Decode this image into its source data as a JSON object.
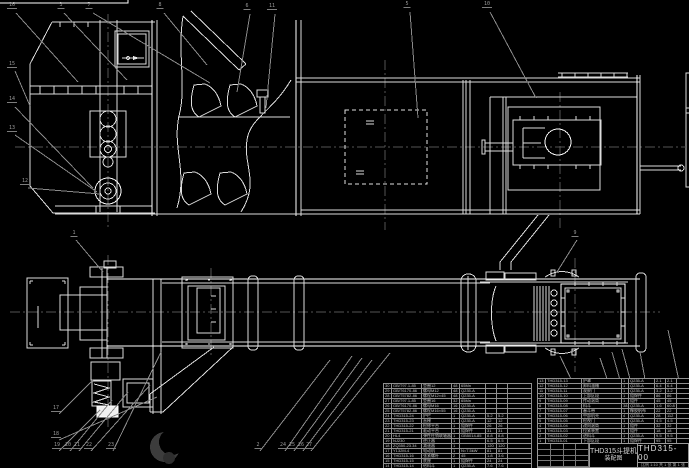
{
  "drawing": {
    "title_line1": "THD315斗提机",
    "title_line2": "装配图",
    "drawing_number": "THD315-00",
    "title_block_note": "比例 1:10  共 1 张  第 1 张"
  },
  "colors": {
    "background": "#000000",
    "drawing_line": "#dcdcdc",
    "leader_line": "#8a8a8a",
    "table_grid": "#8f8f8f",
    "watermark": "#3c3c3c"
  },
  "icons": {
    "watermark": "crescent-logo",
    "hatch_symbol": "flow-arrow-icon"
  },
  "bom_right": {
    "headers": [
      "序号",
      "代  号",
      "名  称",
      "数量",
      "材  料",
      "单重",
      "总重",
      "附注"
    ],
    "rows": [
      [
        "13",
        "THD315-13",
        "护罩",
        "1",
        "Q235-A",
        "2.1",
        "2.1",
        ""
      ],
      [
        "12",
        "THD315-12",
        "卸料溜槽",
        "1",
        "Q235-A",
        "6.4",
        "6.4",
        ""
      ],
      [
        "11",
        "THD315-11",
        "观察门",
        "1",
        "Q235-A",
        "3.2",
        "3.2",
        ""
      ],
      [
        "10",
        "THD315-10",
        "上部区段",
        "1",
        "组焊件",
        "86",
        "86",
        ""
      ],
      [
        "9",
        "THD315-09",
        "传动滚筒",
        "1",
        "组件",
        "45",
        "45",
        ""
      ],
      [
        "8",
        "THD315-08",
        "料斗",
        "38",
        "Q235-A",
        "1.6",
        "60.8",
        ""
      ],
      [
        "7",
        "THD315-07",
        "畚斗带",
        "1",
        "橡胶帆布",
        "22",
        "22",
        ""
      ],
      [
        "6",
        "THD315-06",
        "中部机壳",
        "4",
        "Q235-A",
        "28",
        "112",
        ""
      ],
      [
        "5",
        "THD315-05",
        "检视门",
        "1",
        "Q235-A",
        "4.5",
        "4.5",
        ""
      ],
      [
        "4",
        "THD315-04",
        "改向滚筒",
        "1",
        "组件",
        "32",
        "32",
        ""
      ],
      [
        "3",
        "THD315-03",
        "拉紧装置",
        "1",
        "组件",
        "18",
        "18",
        ""
      ],
      [
        "2",
        "THD315-02",
        "进料斗",
        "1",
        "Q235-A",
        "9.5",
        "9.5",
        ""
      ],
      [
        "1",
        "THD315-01",
        "下部区段",
        "1",
        "组焊件",
        "95",
        "95",
        ""
      ]
    ]
  },
  "bom_left": {
    "rows": [
      [
        "30",
        "GB/T97.1-85",
        "垫圈12",
        "48",
        "65Mn",
        "",
        "",
        ""
      ],
      [
        "29",
        "GB/T6170-86",
        "螺母M12",
        "48",
        "Q235-A",
        "",
        "",
        ""
      ],
      [
        "28",
        "GB/T5782-86",
        "螺栓M12×45",
        "48",
        "Q235-A",
        "",
        "",
        ""
      ],
      [
        "27",
        "GB/T97.1-85",
        "垫圈16",
        "32",
        "65Mn",
        "",
        "",
        ""
      ],
      [
        "26",
        "GB/T6170-86",
        "螺母M16",
        "16",
        "Q235-A",
        "",
        "",
        ""
      ],
      [
        "25",
        "GB/T5782-86",
        "螺栓M16×55",
        "16",
        "Q235-A",
        "",
        "",
        ""
      ],
      [
        "24",
        "THD315-24",
        "护栏",
        "1",
        "Q235-A",
        "5.2",
        "5.2",
        ""
      ],
      [
        "23",
        "THD315-23",
        "直梯",
        "1",
        "Q235-A",
        "12",
        "12",
        ""
      ],
      [
        "22",
        "THD315-22",
        "检修平台",
        "1",
        "组焊件",
        "26",
        "26",
        ""
      ],
      [
        "21",
        "THD315-21",
        "驱动平台",
        "1",
        "组焊件",
        "31",
        "31",
        ""
      ],
      [
        "20",
        "HL4",
        "弹性柱销联轴器",
        "1",
        "GB5014-85",
        "8.8",
        "8.8",
        ""
      ],
      [
        "19",
        "NJ230",
        "逆止器",
        "1",
        "",
        "6.5",
        "6.5",
        ""
      ],
      [
        "18",
        "ZQ350-23.34",
        "减速器",
        "1",
        "",
        "120",
        "120",
        ""
      ],
      [
        "17",
        "Y132M-4",
        "电动机",
        "1",
        "N=7.5kW",
        "81",
        "81",
        ""
      ],
      [
        "16",
        "THD315-16",
        "张紧螺杆",
        "2",
        "45",
        "1.8",
        "3.6",
        ""
      ],
      [
        "15",
        "THD315-15",
        "底座",
        "1",
        "组焊件",
        "24",
        "24",
        ""
      ],
      [
        "14",
        "THD315-14",
        "给料斗",
        "1",
        "Q235-A",
        "7.6",
        "7.6",
        ""
      ]
    ]
  },
  "balloons": [
    {
      "label": "16",
      "x": 12,
      "y": 9
    },
    {
      "label": "3",
      "x": 61,
      "y": 9
    },
    {
      "label": "7",
      "x": 89,
      "y": 9
    },
    {
      "label": "8",
      "x": 160,
      "y": 9
    },
    {
      "label": "6",
      "x": 247,
      "y": 10
    },
    {
      "label": "11",
      "x": 272,
      "y": 10
    },
    {
      "label": "5",
      "x": 407,
      "y": 8
    },
    {
      "label": "10",
      "x": 487,
      "y": 8
    },
    {
      "label": "15",
      "x": 12,
      "y": 68
    },
    {
      "label": "14",
      "x": 12,
      "y": 103
    },
    {
      "label": "13",
      "x": 12,
      "y": 132
    },
    {
      "label": "12",
      "x": 25,
      "y": 185
    },
    {
      "label": "1",
      "x": 74,
      "y": 237
    },
    {
      "label": "17",
      "x": 56,
      "y": 412
    },
    {
      "label": "18",
      "x": 56,
      "y": 438
    },
    {
      "label": "19",
      "x": 57,
      "y": 449
    },
    {
      "label": "20",
      "x": 68,
      "y": 449
    },
    {
      "label": "21",
      "x": 77,
      "y": 449
    },
    {
      "label": "22",
      "x": 89,
      "y": 449
    },
    {
      "label": "23",
      "x": 111,
      "y": 449
    },
    {
      "label": "2",
      "x": 258,
      "y": 449
    },
    {
      "label": "24",
      "x": 283,
      "y": 449
    },
    {
      "label": "25",
      "x": 292,
      "y": 449
    },
    {
      "label": "26",
      "x": 301,
      "y": 449
    },
    {
      "label": "27",
      "x": 309,
      "y": 449
    },
    {
      "label": "9",
      "x": 575,
      "y": 237
    },
    {
      "label": "28",
      "x": 603,
      "y": 448
    },
    {
      "label": "29",
      "x": 628,
      "y": 448
    },
    {
      "label": "30",
      "x": 637,
      "y": 448
    },
    {
      "label": "31",
      "x": 646,
      "y": 448
    },
    {
      "label": "4",
      "x": 655,
      "y": 448
    }
  ]
}
